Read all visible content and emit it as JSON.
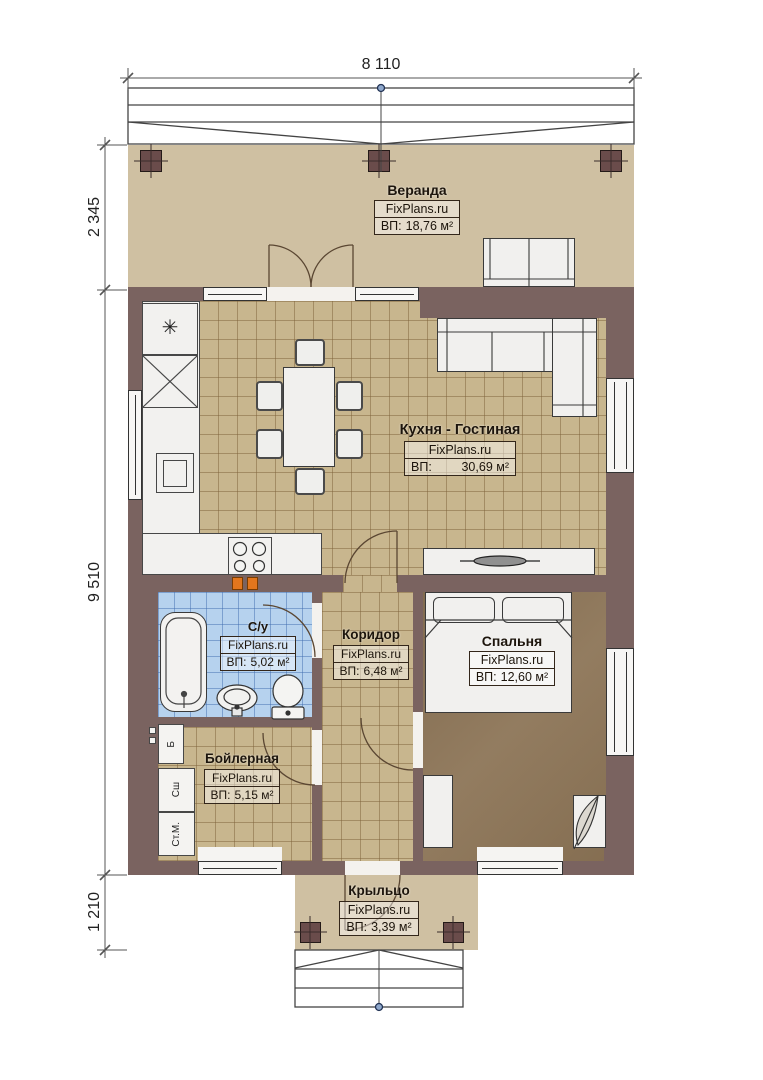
{
  "plan": {
    "dimensions": {
      "width_top": "8 110",
      "veranda_depth": "2 345",
      "house_depth": "9 510",
      "porch_depth": "1 210"
    },
    "brand": "FixPlans.ru",
    "area_prefix": "ВП:",
    "rooms": {
      "veranda": {
        "name": "Веранда",
        "area": "18,76 м²"
      },
      "kitchen_living": {
        "name": "Кухня - Гостиная",
        "area": "30,69 м²"
      },
      "bathroom": {
        "name": "С/у",
        "area": "5,02 м²"
      },
      "corridor": {
        "name": "Коридор",
        "area": "6,48 м²"
      },
      "bedroom": {
        "name": "Спальня",
        "area": "12,60 м²"
      },
      "boiler": {
        "name": "Бойлерная",
        "area": "5,15 м²"
      },
      "porch": {
        "name": "Крыльцо",
        "area": "3,39 м²"
      }
    },
    "appliances": {
      "water_heater": "Б",
      "dryer": "Сш",
      "washer": "Ст.М."
    },
    "icons": {
      "fridge_snowflake": "✳"
    },
    "colors": {
      "wall": "#7a6360",
      "veranda_floor": "#cfc0a2",
      "tile_floor": "#c8b68e",
      "bath_floor": "#b6d2ee",
      "bedroom_floor": "#8c7456",
      "accent_orange": "#e2761d"
    }
  }
}
